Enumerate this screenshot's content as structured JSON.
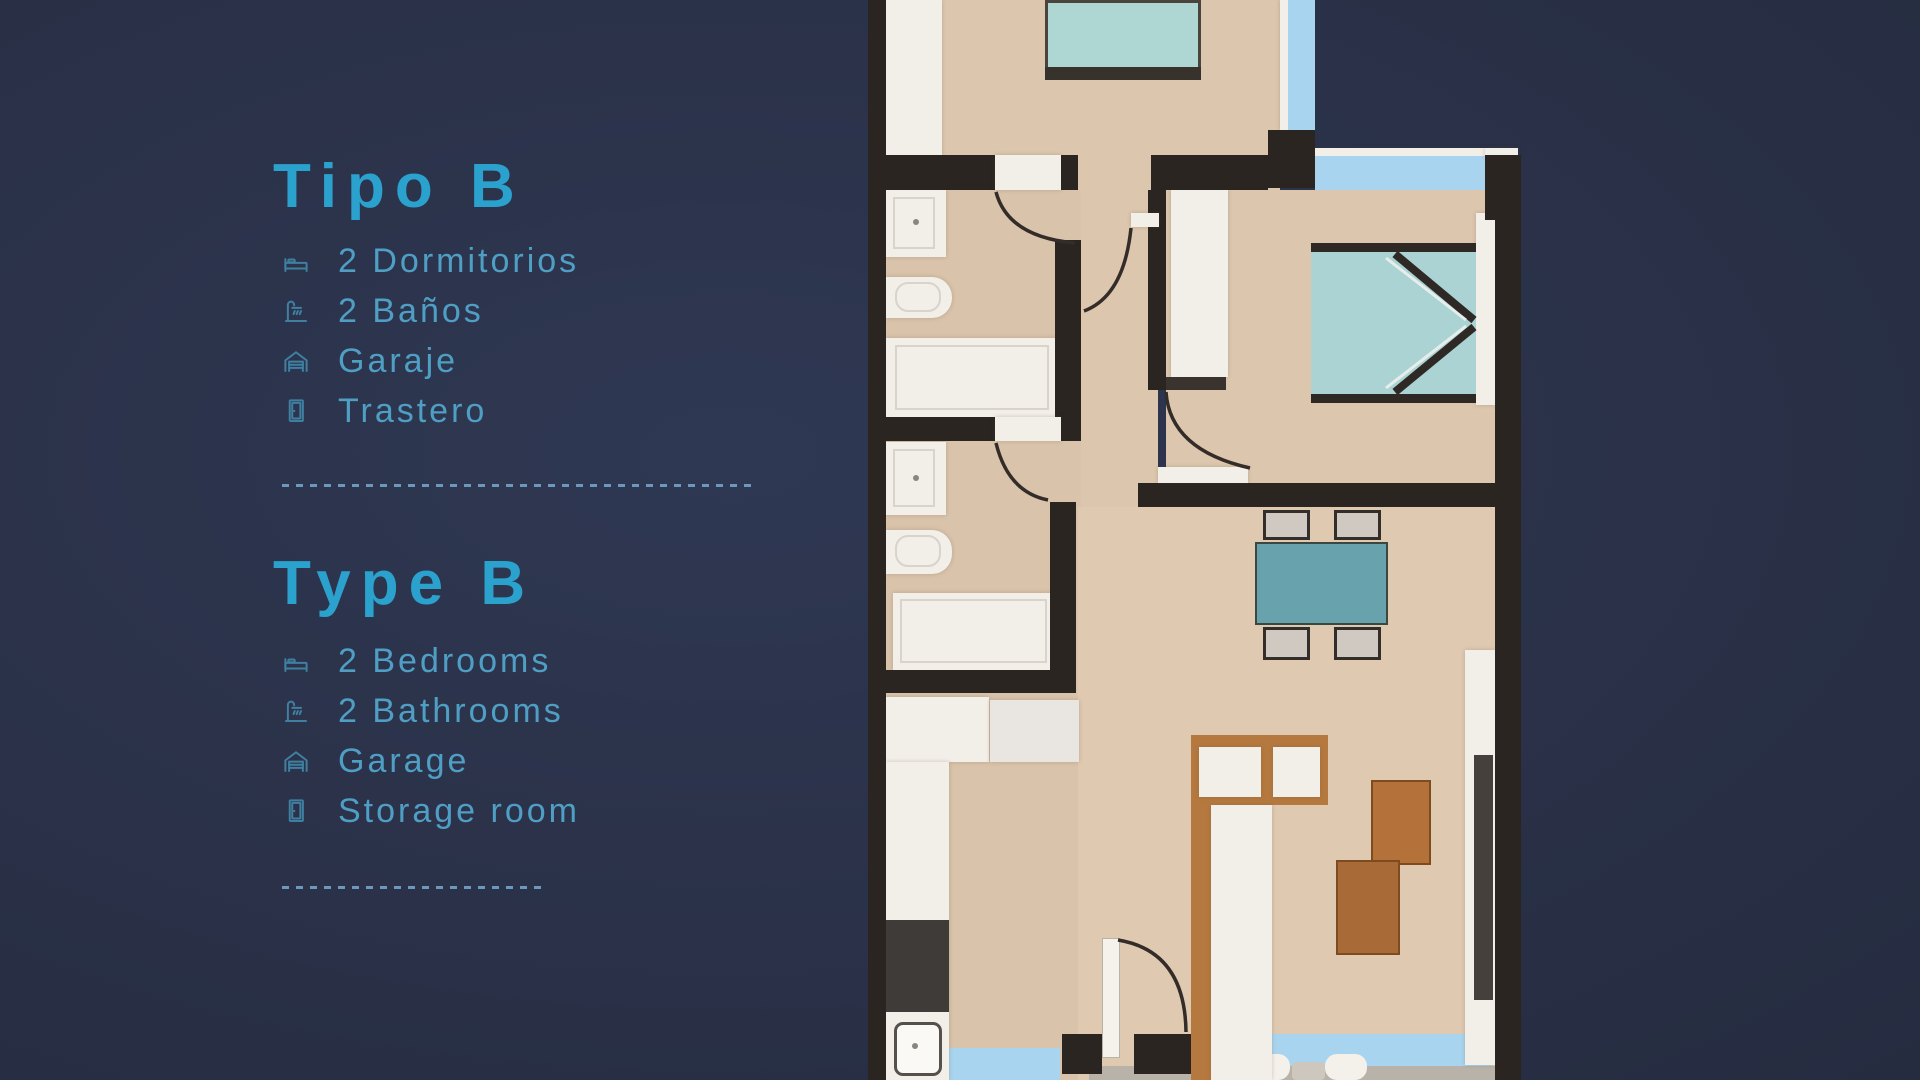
{
  "page": {
    "background": "#2a3148",
    "title_color": "#2ba1cd",
    "text_color": "#4f9ec4",
    "icon_color": "#3f7fa0",
    "divider_color": "#6f9dc1"
  },
  "sections": [
    {
      "lang": "es",
      "title": "Tipo B",
      "items": [
        {
          "icon": "bed-icon",
          "label": "2 Dormitorios"
        },
        {
          "icon": "shower-icon",
          "label": "2 Baños"
        },
        {
          "icon": "garage-icon",
          "label": "Garaje"
        },
        {
          "icon": "door-icon",
          "label": "Trastero"
        }
      ]
    },
    {
      "lang": "en",
      "title": "Type B",
      "items": [
        {
          "icon": "bed-icon",
          "label": "2 Bedrooms"
        },
        {
          "icon": "shower-icon",
          "label": "2 Bathrooms"
        },
        {
          "icon": "garage-icon",
          "label": "Garage"
        },
        {
          "icon": "door-icon",
          "label": "Storage room"
        }
      ]
    }
  ],
  "floor_plan": {
    "type": "apartment-floor-plan-top-view",
    "rooms": [
      "bedroom-1",
      "ensuite-bathroom",
      "bathroom-2",
      "hallway",
      "bedroom-2",
      "kitchen",
      "living-dining-room",
      "terrace"
    ],
    "palette": {
      "wall": "#2b2522",
      "floor": "#dcc6ae",
      "fixtures": "#f2efe8",
      "beds": "#abd3d4",
      "dining_table": "#68a2ac",
      "windows": "#a9d4ef",
      "wood_furniture": "#b5793f",
      "terrace_floor": "#b8b2a9"
    }
  }
}
